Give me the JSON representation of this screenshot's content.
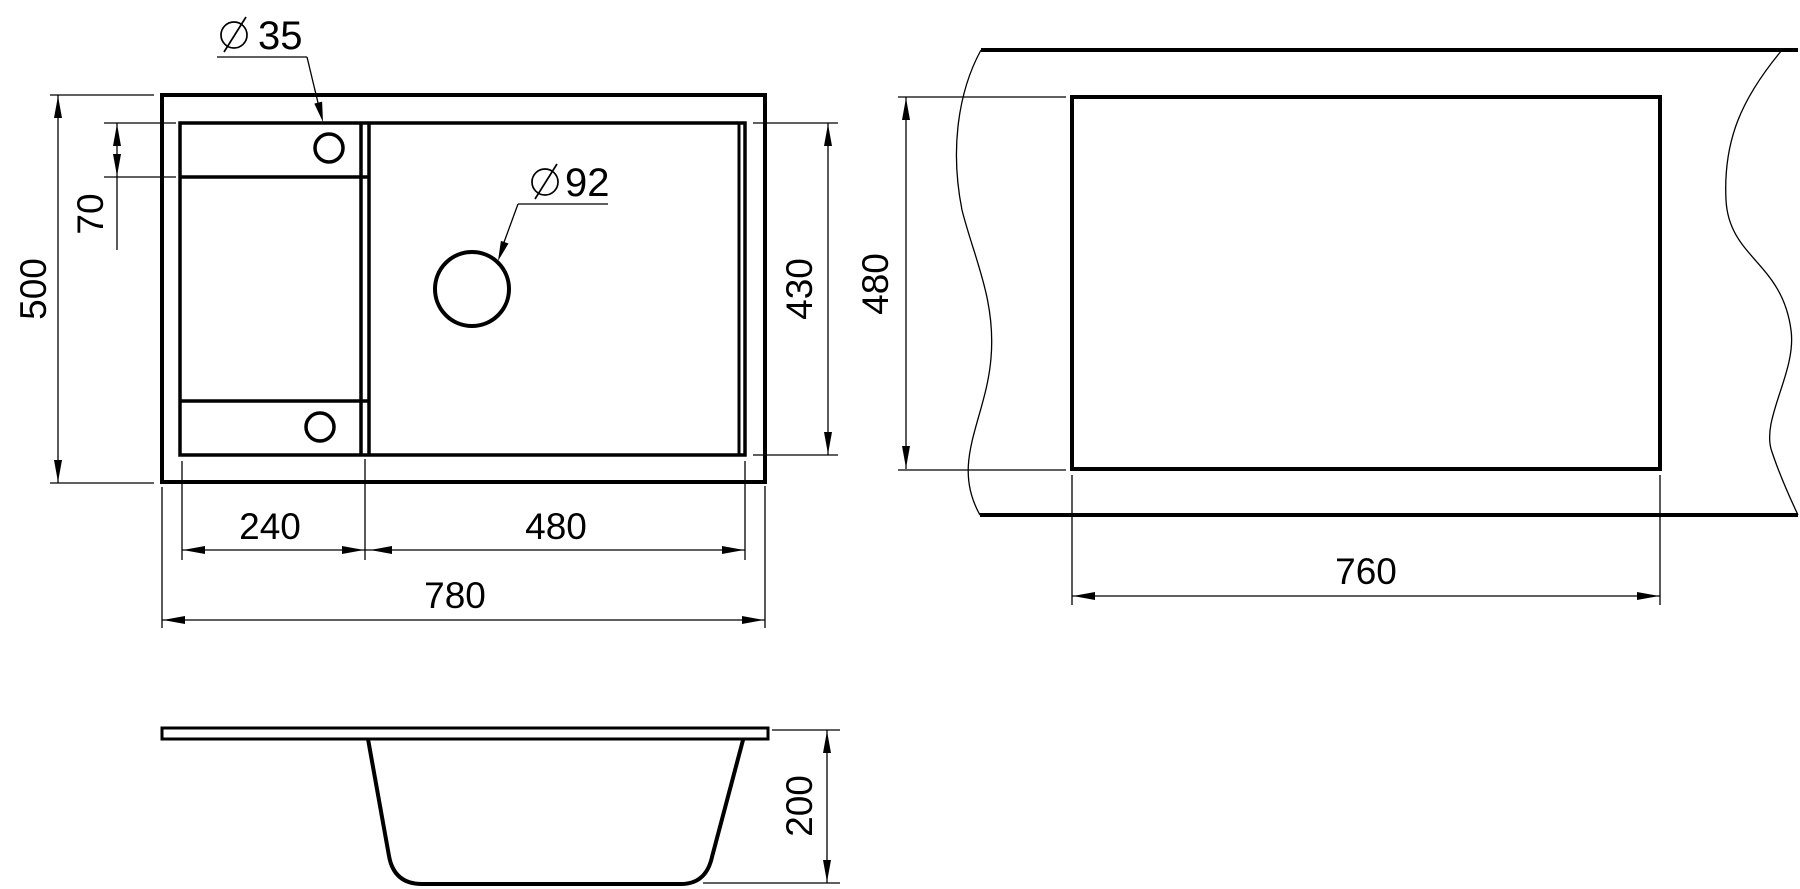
{
  "canvas": {
    "background": "#ffffff",
    "line_color": "#000000"
  },
  "plan_view": {
    "dim_total_width": "780",
    "dim_bowl_width": "240",
    "dim_drain_width": "480",
    "dim_total_depth": "500",
    "dim_inner_depth": "430",
    "dim_hole_offset": "70",
    "hole_small_diameter": "35",
    "hole_large_diameter": "92",
    "diameter_symbol": "⌀"
  },
  "cutout_view": {
    "dim_cutout_width": "760",
    "dim_cutout_depth": "480"
  },
  "section_view": {
    "dim_bowl_depth": "200"
  }
}
